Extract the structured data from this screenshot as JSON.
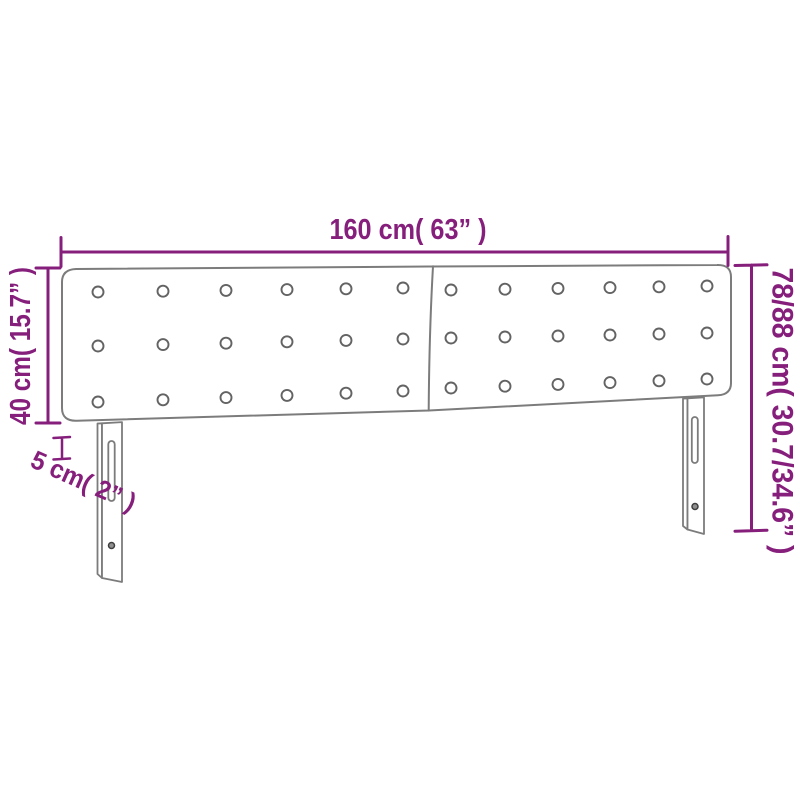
{
  "page": {
    "background_color": "#ffffff"
  },
  "diagram": {
    "kind": "furniture-dimension-diagram",
    "subject": "upholstered headboard with two tufted panels and two slotted mounting legs",
    "accent_color": "#861f7c",
    "outline_color": "#7c7c7c",
    "dimensions": {
      "width": {
        "label": "160 cm( 63” )",
        "cm": 160,
        "inches": 63
      },
      "panel_height": {
        "label": "40 cm( 15.7” )",
        "cm": 40,
        "inches": 15.7
      },
      "thickness": {
        "label": "5 cm( 2” )",
        "cm": 5,
        "inches": 2
      },
      "total_height": {
        "label": "78/88 cm( 30.7/34.6” )",
        "cm": "78/88",
        "inches": "30.7/34.6"
      }
    },
    "headboard": {
      "panel_count": 2,
      "tufting_buttons_per_panel": {
        "rows": 3,
        "cols": 6
      },
      "leg_count": 2
    }
  }
}
